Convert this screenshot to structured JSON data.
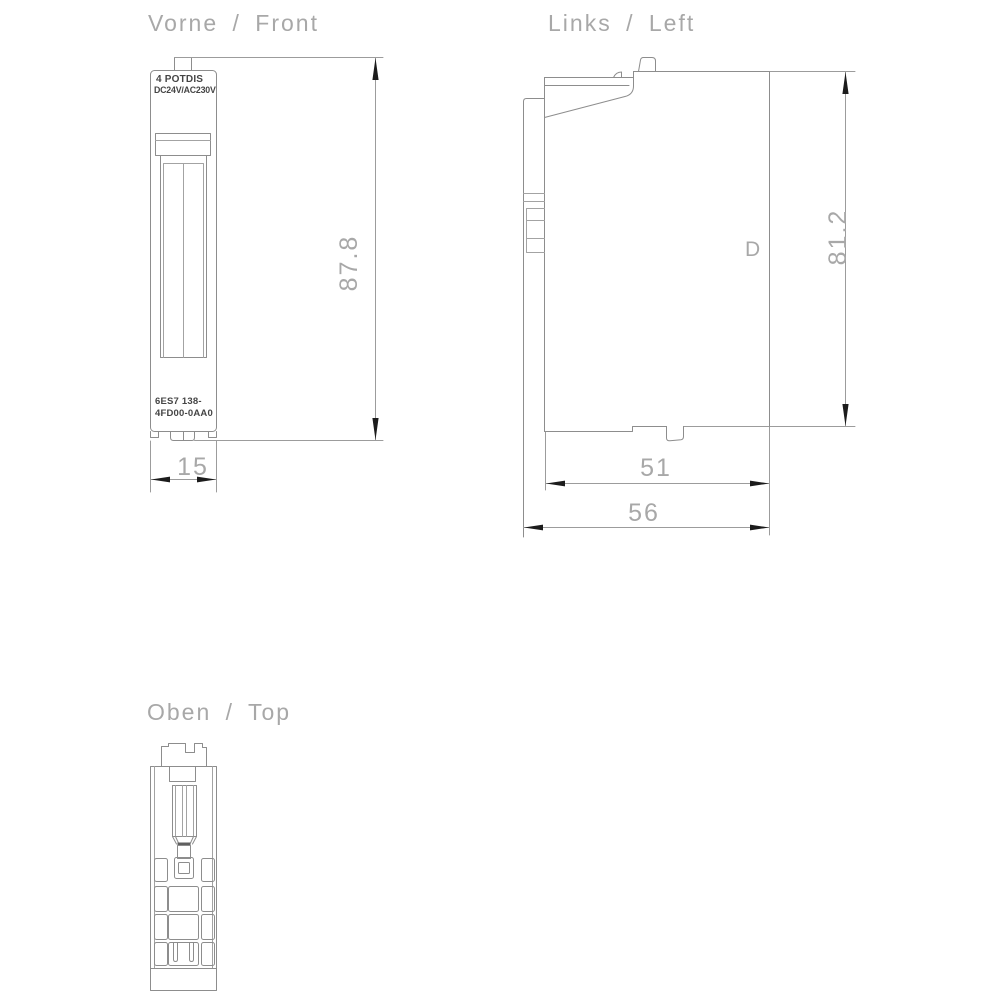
{
  "page": {
    "background": "#ffffff"
  },
  "drawing": {
    "front_view": {
      "title": "Vorne / Front",
      "module_type": "4 POTDIS",
      "module_voltage": "DC24V/AC230V",
      "part_number_line1": "6ES7 138-",
      "part_number_line2": "4FD00-0AA0",
      "height_dim": "87.8",
      "width_dim": "15"
    },
    "left_view": {
      "title": "Links / Left",
      "marking": "D",
      "height_dim": "81.2",
      "depth_dim_inner": "51",
      "depth_dim_outer": "56"
    },
    "top_view": {
      "title": "Oben / Top"
    },
    "colors": {
      "object_line": "#8d8d8d",
      "dimension_line": "#9c9c9c",
      "dimension_text": "#a8a8a8",
      "label_text": "#454545",
      "arrow": "#1c1c1c",
      "background": "#ffffff"
    }
  }
}
